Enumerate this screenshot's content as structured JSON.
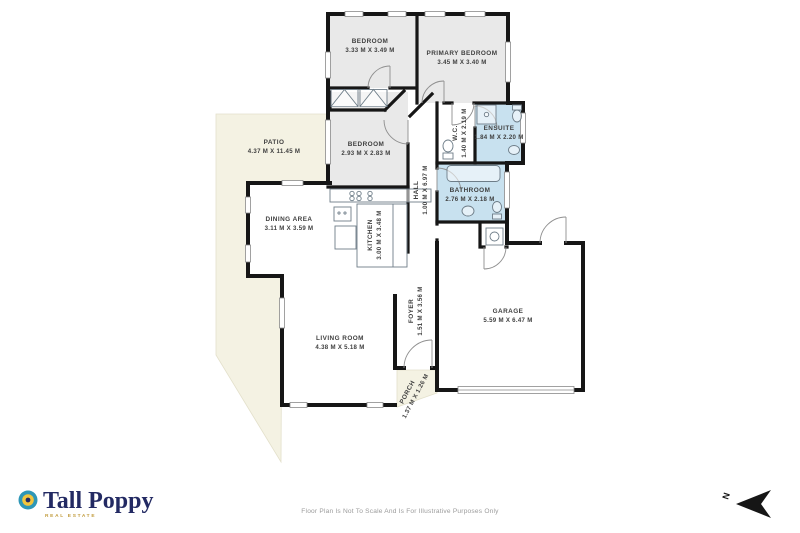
{
  "plan": {
    "rooms": [
      {
        "id": "bedroom-1",
        "name": "BEDROOM",
        "dims": "3.33 M X 3.49 M"
      },
      {
        "id": "primary-bedroom",
        "name": "PRIMARY BEDROOM",
        "dims": "3.45 M X 3.40 M"
      },
      {
        "id": "bedroom-2",
        "name": "BEDROOM",
        "dims": "2.93 M X 2.83 M"
      },
      {
        "id": "wc",
        "name": "W.C.",
        "dims": "1.40 M X 2.19 M"
      },
      {
        "id": "ensuite",
        "name": "ENSUITE",
        "dims": "1.84 M X 2.20 M"
      },
      {
        "id": "hall",
        "name": "HALL",
        "dims": "1.00 M X 6.97 M"
      },
      {
        "id": "bathroom",
        "name": "BATHROOM",
        "dims": "2.76 M X 2.18 M"
      },
      {
        "id": "patio",
        "name": "PATIO",
        "dims": "4.37 M X 11.45 M"
      },
      {
        "id": "dining-area",
        "name": "DINING AREA",
        "dims": "3.11 M X 3.59 M"
      },
      {
        "id": "kitchen",
        "name": "KITCHEN",
        "dims": "3.00 M X 3.48 M"
      },
      {
        "id": "living-room",
        "name": "LIVING ROOM",
        "dims": "4.38 M X 5.18 M"
      },
      {
        "id": "foyer",
        "name": "FOYER",
        "dims": "1.51 M X 3.56 M"
      },
      {
        "id": "porch",
        "name": "PORCH",
        "dims": "1.37 M X 1.26 M"
      },
      {
        "id": "garage",
        "name": "GARAGE",
        "dims": "5.59 M X 6.47 M"
      }
    ],
    "compass": {
      "label": "N"
    }
  },
  "footer": {
    "disclaimer": "Floor Plan Is Not To Scale And Is For Illustrative Purposes Only"
  },
  "logo": {
    "brand": "Tall Poppy",
    "tagline": "REAL ESTATE"
  },
  "colors": {
    "wall": "#161616",
    "bedroom_fill": "#e9e9e9",
    "bath_fill": "#c8e1ef",
    "outdoor_fill": "#f4f2e3",
    "label_text": "#3f3f3f",
    "logo_navy": "#232a63",
    "logo_gold": "#c19b3c",
    "icon_teal": "#2e97b7",
    "icon_gold": "#f2c53d",
    "disclaimer_gray": "#9b9b9b"
  }
}
